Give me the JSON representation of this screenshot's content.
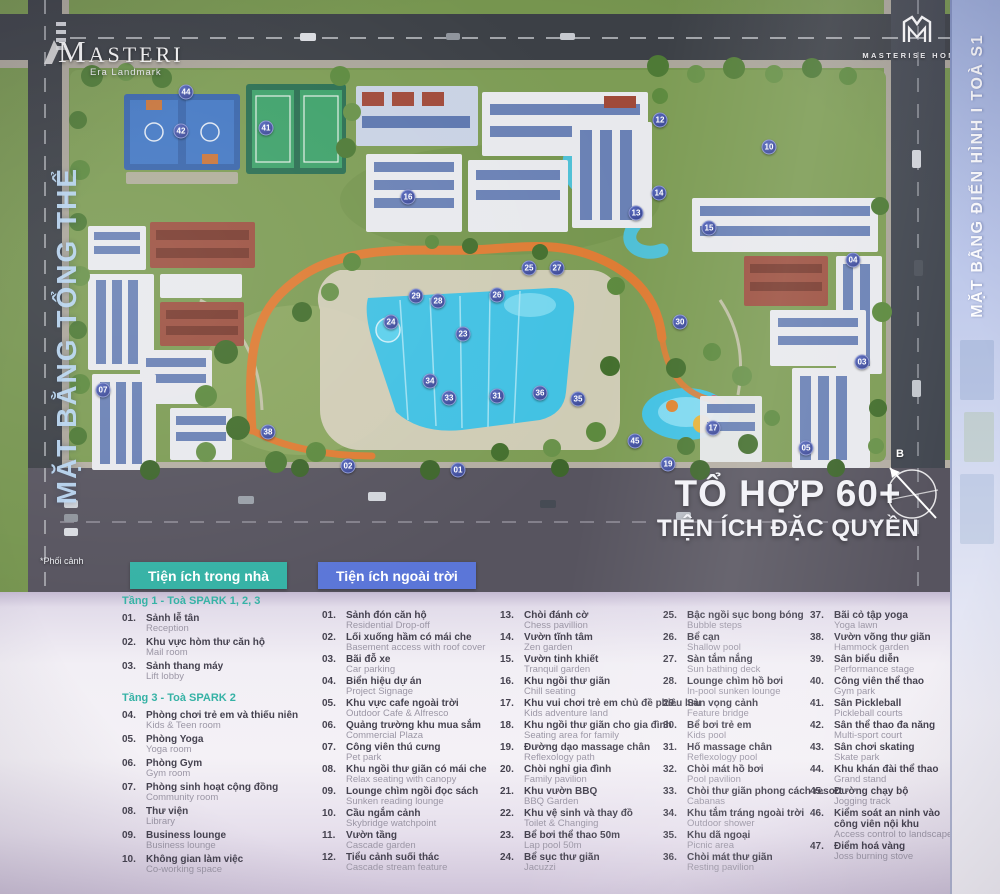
{
  "poster": {
    "masteri_logo": {
      "title": "MASTERI",
      "subtitle": "Era Landmark"
    },
    "masterise_logo": {
      "line1": "MASTERISE HOMES"
    },
    "left_vertical_label": "MẶT BẰNG TỔNG THỂ",
    "right_vertical_label": "MẶT BẰNG ĐIỂN HÌNH  I  TOÀ S1",
    "headline_line1": "TỔ HỢP 60+",
    "headline_line2": "TIỆN ÍCH ĐẶC QUYỀN",
    "compass_label": "B",
    "footnote": "*Phối cảnh"
  },
  "map": {
    "markers": [
      {
        "n": "44",
        "x": 186,
        "y": 92
      },
      {
        "n": "42",
        "x": 181,
        "y": 131
      },
      {
        "n": "41",
        "x": 266,
        "y": 128
      },
      {
        "n": "12",
        "x": 660,
        "y": 120
      },
      {
        "n": "10",
        "x": 769,
        "y": 147
      },
      {
        "n": "16",
        "x": 408,
        "y": 197
      },
      {
        "n": "14",
        "x": 659,
        "y": 193
      },
      {
        "n": "13",
        "x": 636,
        "y": 213
      },
      {
        "n": "15",
        "x": 709,
        "y": 228
      },
      {
        "n": "04",
        "x": 853,
        "y": 260
      },
      {
        "n": "25",
        "x": 529,
        "y": 268
      },
      {
        "n": "27",
        "x": 557,
        "y": 268
      },
      {
        "n": "26",
        "x": 497,
        "y": 295
      },
      {
        "n": "29",
        "x": 416,
        "y": 296
      },
      {
        "n": "28",
        "x": 438,
        "y": 301
      },
      {
        "n": "24",
        "x": 391,
        "y": 322
      },
      {
        "n": "23",
        "x": 463,
        "y": 334
      },
      {
        "n": "30",
        "x": 680,
        "y": 322
      },
      {
        "n": "03",
        "x": 862,
        "y": 362
      },
      {
        "n": "34",
        "x": 430,
        "y": 381
      },
      {
        "n": "31",
        "x": 497,
        "y": 396
      },
      {
        "n": "33",
        "x": 449,
        "y": 398
      },
      {
        "n": "36",
        "x": 540,
        "y": 393
      },
      {
        "n": "35",
        "x": 578,
        "y": 399
      },
      {
        "n": "38",
        "x": 268,
        "y": 432
      },
      {
        "n": "17",
        "x": 713,
        "y": 428
      },
      {
        "n": "45",
        "x": 635,
        "y": 441
      },
      {
        "n": "19",
        "x": 668,
        "y": 464
      },
      {
        "n": "02",
        "x": 348,
        "y": 466
      },
      {
        "n": "01",
        "x": 458,
        "y": 470
      },
      {
        "n": "05",
        "x": 806,
        "y": 448
      },
      {
        "n": "07",
        "x": 103,
        "y": 390
      }
    ]
  },
  "amenities": {
    "indoor": {
      "header": "Tiện ích trong nhà",
      "accent": "#35b2a5",
      "groups": [
        {
          "title": "Tầng 1 - Toà SPARK 1, 2, 3",
          "items": [
            {
              "n": "01",
              "vi": "Sảnh lễ tân",
              "en": "Reception"
            },
            {
              "n": "02",
              "vi": "Khu vực hòm thư căn hộ",
              "en": "Mail room"
            },
            {
              "n": "03",
              "vi": "Sảnh thang máy",
              "en": "Lift lobby"
            }
          ]
        },
        {
          "title": "Tầng 3 - Toà SPARK 2",
          "items": [
            {
              "n": "04",
              "vi": "Phòng chơi trẻ em và thiếu niên",
              "en": "Kids & Teen room"
            },
            {
              "n": "05",
              "vi": "Phòng Yoga",
              "en": "Yoga room"
            },
            {
              "n": "06",
              "vi": "Phòng Gym",
              "en": "Gym room"
            },
            {
              "n": "07",
              "vi": "Phòng sinh hoạt cộng đồng",
              "en": "Community room"
            },
            {
              "n": "08",
              "vi": "Thư viện",
              "en": "Library"
            },
            {
              "n": "09",
              "vi": "Business lounge",
              "en": "Business lounge"
            },
            {
              "n": "10",
              "vi": "Không gian làm việc",
              "en": "Co-working space"
            }
          ]
        }
      ]
    },
    "outdoor": {
      "header": "Tiện ích ngoài trời",
      "accent": "#5b76d8",
      "columns": [
        [
          {
            "n": "01",
            "vi": "Sảnh đón căn hộ",
            "en": "Residential Drop-off"
          },
          {
            "n": "02",
            "vi": "Lối xuống hầm có mái che",
            "en": "Basement access with roof cover"
          },
          {
            "n": "03",
            "vi": "Bãi đỗ xe",
            "en": "Car parking"
          },
          {
            "n": "04",
            "vi": "Biển hiệu dự án",
            "en": "Project Signage"
          },
          {
            "n": "05",
            "vi": "Khu vực cafe ngoài trời",
            "en": "Outdoor Cafe & Alfresco"
          },
          {
            "n": "06",
            "vi": "Quảng trường khu mua sắm",
            "en": "Commercial Plaza"
          },
          {
            "n": "07",
            "vi": "Công viên thú cưng",
            "en": "Pet park"
          },
          {
            "n": "08",
            "vi": "Khu ngồi thư giãn có mái che",
            "en": "Relax seating with canopy"
          },
          {
            "n": "09",
            "vi": "Lounge chìm ngồi đọc sách",
            "en": "Sunken reading lounge"
          },
          {
            "n": "10",
            "vi": "Cầu ngắm cảnh",
            "en": "Skybridge watchpoint"
          },
          {
            "n": "11",
            "vi": "Vườn tầng",
            "en": "Cascade garden"
          },
          {
            "n": "12",
            "vi": "Tiểu cảnh suối thác",
            "en": "Cascade stream feature"
          }
        ],
        [
          {
            "n": "13",
            "vi": "Chòi đánh cờ",
            "en": "Chess pavillion"
          },
          {
            "n": "14",
            "vi": "Vườn tĩnh tâm",
            "en": "Zen garden"
          },
          {
            "n": "15",
            "vi": "Vườn tinh khiết",
            "en": "Tranquil garden"
          },
          {
            "n": "16",
            "vi": "Khu ngồi thư giãn",
            "en": "Chill seating"
          },
          {
            "n": "17",
            "vi": "Khu vui chơi trẻ em chủ đề phiêu lưu",
            "en": "Kids adventure land"
          },
          {
            "n": "18",
            "vi": "Khu ngồi thư giãn cho gia đình",
            "en": "Seating area for family"
          },
          {
            "n": "19",
            "vi": "Đường dạo massage chân",
            "en": "Reflexology path"
          },
          {
            "n": "20",
            "vi": "Chòi nghỉ gia đình",
            "en": "Family pavilion"
          },
          {
            "n": "21",
            "vi": "Khu vườn BBQ",
            "en": "BBQ Garden"
          },
          {
            "n": "22",
            "vi": "Khu vệ sinh và thay đồ",
            "en": "Toilet & Changing"
          },
          {
            "n": "23",
            "vi": "Bể bơi thể thao 50m",
            "en": "Lap pool 50m"
          },
          {
            "n": "24",
            "vi": "Bể sục thư giãn",
            "en": "Jacuzzi"
          }
        ],
        [
          {
            "n": "25",
            "vi": "Bậc ngồi sục bong bóng",
            "en": "Bubble steps"
          },
          {
            "n": "26",
            "vi": "Bể cạn",
            "en": "Shallow pool"
          },
          {
            "n": "27",
            "vi": "Sàn tắm nắng",
            "en": "Sun bathing deck"
          },
          {
            "n": "28",
            "vi": "Lounge chìm hồ bơi",
            "en": "In-pool sunken lounge"
          },
          {
            "n": "29",
            "vi": "Sàn vọng cảnh",
            "en": "Feature bridge"
          },
          {
            "n": "30",
            "vi": "Bể bơi trẻ em",
            "en": "Kids pool"
          },
          {
            "n": "31",
            "vi": "Hố massage chân",
            "en": "Reflexology pool"
          },
          {
            "n": "32",
            "vi": "Chòi mát hồ bơi",
            "en": "Pool pavilion"
          },
          {
            "n": "33",
            "vi": "Chòi thư giãn phong cách resort",
            "en": "Cabanas"
          },
          {
            "n": "34",
            "vi": "Khu tắm tráng ngoài trời",
            "en": "Outdoor shower"
          },
          {
            "n": "35",
            "vi": "Khu dã ngoại",
            "en": "Picnic area"
          },
          {
            "n": "36",
            "vi": "Chòi mát thư giãn",
            "en": "Resting pavilion"
          }
        ],
        [
          {
            "n": "37",
            "vi": "Bãi cỏ tập yoga",
            "en": "Yoga lawn"
          },
          {
            "n": "38",
            "vi": "Vườn võng thư giãn",
            "en": "Hammock garden"
          },
          {
            "n": "39",
            "vi": "Sân biểu diễn",
            "en": "Performance stage"
          },
          {
            "n": "40",
            "vi": "Công viên thể thao",
            "en": "Gym park"
          },
          {
            "n": "41",
            "vi": "Sân Pickleball",
            "en": "Pickleball courts"
          },
          {
            "n": "42",
            "vi": "Sân thể thao đa năng",
            "en": "Multi-sport court"
          },
          {
            "n": "43",
            "vi": "Sân chơi skating",
            "en": "Skate park"
          },
          {
            "n": "44",
            "vi": "Khu khán đài thể thao",
            "en": "Grand stand"
          },
          {
            "n": "45",
            "vi": "Đường chạy bộ",
            "en": "Jogging track"
          },
          {
            "n": "46",
            "vi": "Kiểm soát an ninh vào\ncông viên nội khu",
            "en": "Access control to landscape"
          },
          {
            "n": "47",
            "vi": "Điểm hoá vàng",
            "en": "Joss burning stove"
          }
        ]
      ]
    }
  }
}
